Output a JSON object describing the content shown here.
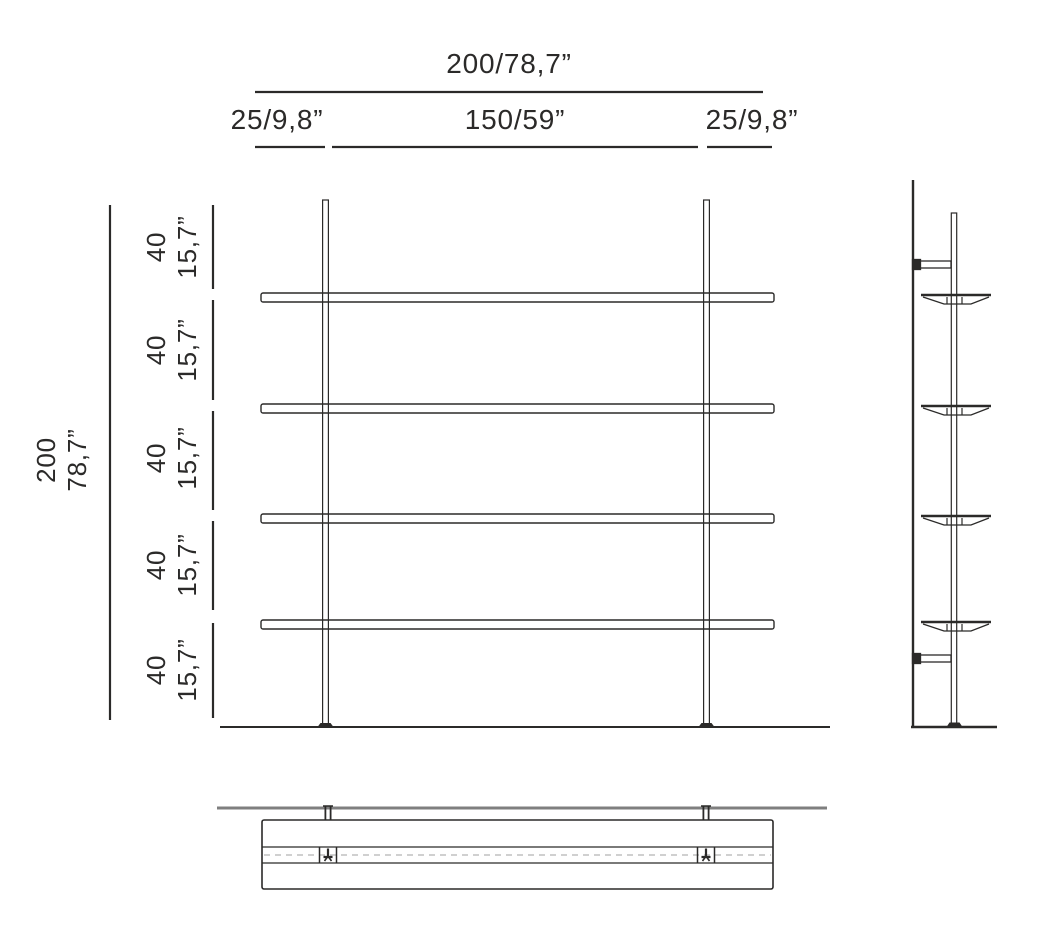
{
  "drawing": {
    "kind": "wall shelving unit dimension drawing",
    "colors": {
      "line": "#2b2a29",
      "wall_line": "#7f7f7f",
      "dashed_line": "#a0a0a0",
      "background": "#ffffff"
    },
    "top_dimensions": {
      "total_width_label": "200/78,7”",
      "left_offset_label": "25/9,8”",
      "center_span_label": "150/59”",
      "right_offset_label": "25/9,8”"
    },
    "left_dimensions": {
      "total_height": {
        "cm": "200",
        "inches": "78,7”"
      },
      "segments": [
        {
          "cm": "40",
          "inches": "15,7”"
        },
        {
          "cm": "40",
          "inches": "15,7”"
        },
        {
          "cm": "40",
          "inches": "15,7”"
        },
        {
          "cm": "40",
          "inches": "15,7”"
        },
        {
          "cm": "40",
          "inches": "15,7”"
        }
      ]
    },
    "counts": {
      "shelves": 4,
      "posts": 2,
      "wall_brackets": 2
    }
  }
}
